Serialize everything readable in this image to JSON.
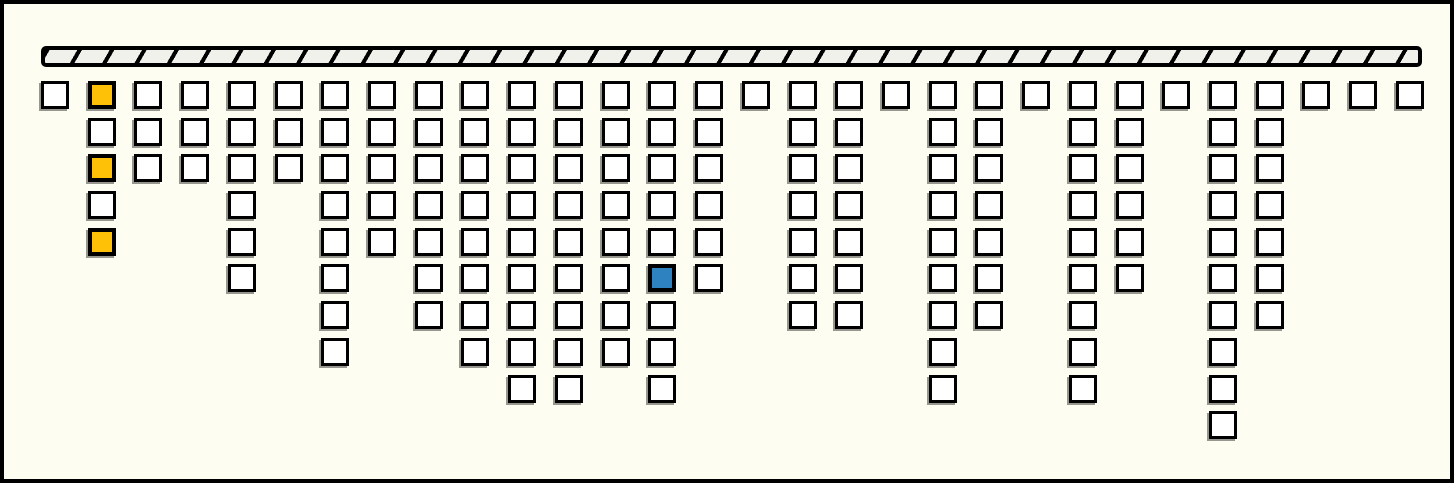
{
  "diagram": {
    "description": "hatched beam with columns of square nodes hanging below",
    "background": "#FDFDF1",
    "frame_color": "#000000",
    "beam": {
      "fill": "#F1F1EB",
      "hatch_color": "#000000",
      "outline_color": "#000000",
      "hatch_count": 43
    },
    "cell_colors": {
      "w": "#FFFFFF",
      "y": "#FFC107",
      "b": "#2E82C0"
    },
    "cell_border_color": "#000000",
    "cell_shadow_color": "#97978F",
    "column_count": 30,
    "total_cells": 159,
    "columns": [
      {
        "cells": [
          "w"
        ]
      },
      {
        "cells": [
          "y",
          "w",
          "y",
          "w",
          "y"
        ]
      },
      {
        "cells": [
          "w",
          "w",
          "w"
        ]
      },
      {
        "cells": [
          "w",
          "w",
          "w"
        ]
      },
      {
        "cells": [
          "w",
          "w",
          "w",
          "w",
          "w",
          "w"
        ]
      },
      {
        "cells": [
          "w",
          "w",
          "w"
        ]
      },
      {
        "cells": [
          "w",
          "w",
          "w",
          "w",
          "w",
          "w",
          "w",
          "w"
        ]
      },
      {
        "cells": [
          "w",
          "w",
          "w",
          "w",
          "w"
        ]
      },
      {
        "cells": [
          "w",
          "w",
          "w",
          "w",
          "w",
          "w",
          "w"
        ]
      },
      {
        "cells": [
          "w",
          "w",
          "w",
          "w",
          "w",
          "w",
          "w",
          "w"
        ]
      },
      {
        "cells": [
          "w",
          "w",
          "w",
          "w",
          "w",
          "w",
          "w",
          "w",
          "w"
        ]
      },
      {
        "cells": [
          "w",
          "w",
          "w",
          "w",
          "w",
          "w",
          "w",
          "w",
          "w"
        ]
      },
      {
        "cells": [
          "w",
          "w",
          "w",
          "w",
          "w",
          "w",
          "w",
          "w"
        ]
      },
      {
        "cells": [
          "w",
          "w",
          "w",
          "w",
          "w",
          "b",
          "w",
          "w",
          "w"
        ]
      },
      {
        "cells": [
          "w",
          "w",
          "w",
          "w",
          "w",
          "w"
        ]
      },
      {
        "cells": [
          "w"
        ]
      },
      {
        "cells": [
          "w",
          "w",
          "w",
          "w",
          "w",
          "w",
          "w"
        ]
      },
      {
        "cells": [
          "w",
          "w",
          "w",
          "w",
          "w",
          "w",
          "w"
        ]
      },
      {
        "cells": [
          "w"
        ]
      },
      {
        "cells": [
          "w",
          "w",
          "w",
          "w",
          "w",
          "w",
          "w",
          "w",
          "w"
        ]
      },
      {
        "cells": [
          "w",
          "w",
          "w",
          "w",
          "w",
          "w",
          "w"
        ]
      },
      {
        "cells": [
          "w"
        ]
      },
      {
        "cells": [
          "w",
          "w",
          "w",
          "w",
          "w",
          "w",
          "w",
          "w",
          "w"
        ]
      },
      {
        "cells": [
          "w",
          "w",
          "w",
          "w",
          "w",
          "w"
        ]
      },
      {
        "cells": [
          "w"
        ]
      },
      {
        "cells": [
          "w",
          "w",
          "w",
          "w",
          "w",
          "w",
          "w",
          "w",
          "w",
          "w"
        ]
      },
      {
        "cells": [
          "w",
          "w",
          "w",
          "w",
          "w",
          "w",
          "w"
        ]
      },
      {
        "cells": [
          "w"
        ]
      },
      {
        "cells": [
          "w"
        ]
      },
      {
        "cells": [
          "w"
        ]
      }
    ]
  }
}
